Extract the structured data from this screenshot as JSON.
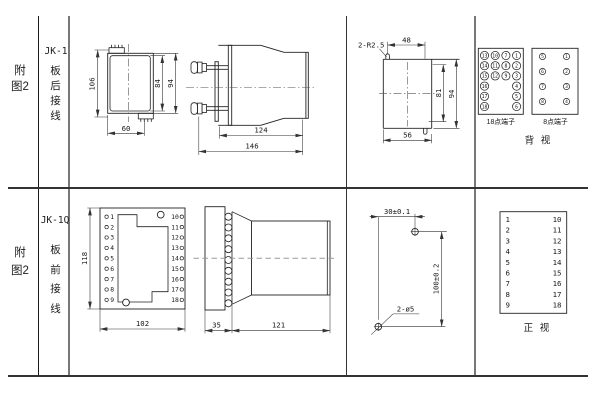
{
  "top_section": {
    "fig": "附图2",
    "model": "JK-1",
    "wiring": "板后接线"
  },
  "bottom_section": {
    "fig": "附图2",
    "model": "JK-1Q",
    "wiring": "板前接线"
  },
  "jk1_front": {
    "d106": "106",
    "d84": "84",
    "d94": "94",
    "d60": "60"
  },
  "jk1_side": {
    "d124": "124",
    "d146": "146"
  },
  "cutout": {
    "radius": "2-R2.5",
    "d48": "48",
    "d81": "81",
    "d94": "94",
    "d56": "56"
  },
  "rear": {
    "t18_title": "18点端子",
    "t8_title": "8点端子",
    "caption": "背 视",
    "t18c1": [
      "13",
      "14",
      "15",
      "16",
      "17",
      "18"
    ],
    "t18c2": [
      "10",
      "11",
      "12"
    ],
    "t18c3": [
      "7",
      "8",
      "9"
    ],
    "t18c4": [
      "1",
      "2",
      "3",
      "4",
      "5",
      "6"
    ],
    "t8c1": [
      "5",
      "6",
      "7",
      "8"
    ],
    "t8c2": [
      "1",
      "2",
      "3",
      "4"
    ]
  },
  "jk1q_front": {
    "left": [
      "1",
      "2",
      "3",
      "4",
      "5",
      "6",
      "7",
      "8",
      "9"
    ],
    "right": [
      "10",
      "11",
      "12",
      "13",
      "14",
      "15",
      "16",
      "17",
      "18"
    ],
    "d118": "118",
    "d102": "102"
  },
  "jk1q_side": {
    "d35": "35",
    "d121": "121"
  },
  "drill": {
    "d30": "30±0.1",
    "d100": "100±0.2",
    "holes": "2-ø5"
  },
  "table": {
    "left": [
      "1",
      "2",
      "3",
      "4",
      "5",
      "6",
      "7",
      "8",
      "9"
    ],
    "right": [
      "10",
      "11",
      "12",
      "13",
      "14",
      "15",
      "16",
      "17",
      "18"
    ],
    "caption": "正 视"
  }
}
